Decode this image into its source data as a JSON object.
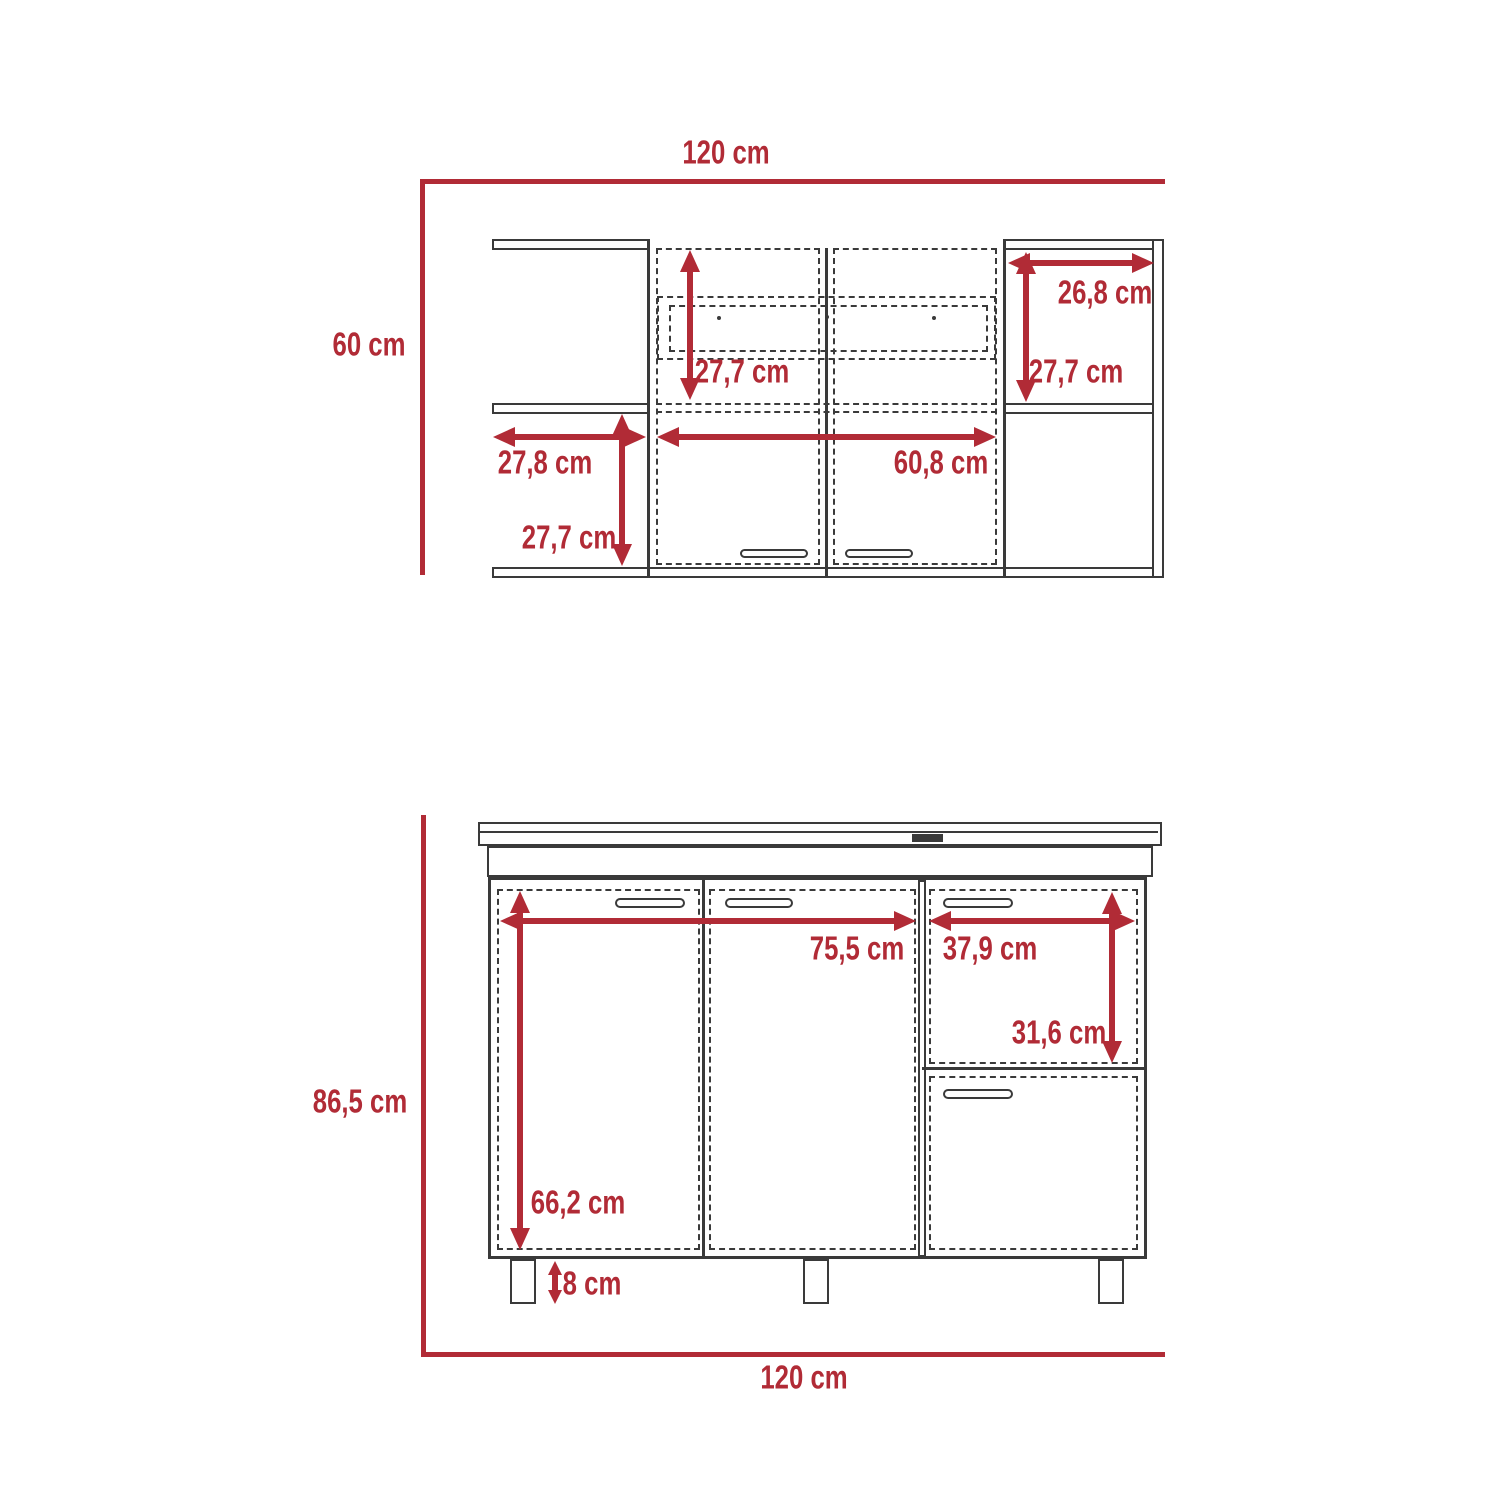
{
  "colors": {
    "dimension_red": "#B12B36",
    "line_dark": "#3A3A3A",
    "background": "#FFFFFF"
  },
  "top_diagram": {
    "title": "wall cabinet front view",
    "overall_width": {
      "label": "120 cm"
    },
    "overall_height": {
      "label": "60 cm"
    },
    "door_opening_height": {
      "label": "27,7 cm"
    },
    "right_shelf_width": {
      "label": "26,8 cm"
    },
    "right_shelf_height": {
      "label": "27,7 cm"
    },
    "left_shelf_width": {
      "label": "27,8 cm"
    },
    "double_door_width": {
      "label": "60,8 cm"
    },
    "left_lower_shelf_height": {
      "label": "27,7 cm"
    }
  },
  "bottom_diagram": {
    "title": "base cabinet front view",
    "overall_width": {
      "label": "120 cm"
    },
    "overall_height": {
      "label": "86,5 cm"
    },
    "door_section_width": {
      "label": "75,5 cm"
    },
    "drawer_width": {
      "label": "37,9 cm"
    },
    "drawer_height": {
      "label": "31,6 cm"
    },
    "door_height": {
      "label": "66,2 cm"
    },
    "leg_height": {
      "label": "8 cm"
    }
  }
}
